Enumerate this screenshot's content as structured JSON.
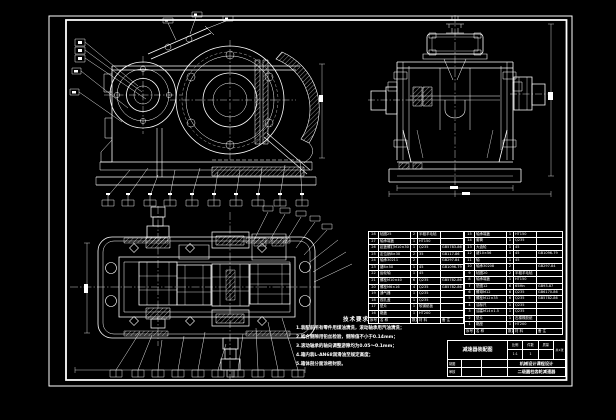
{
  "colors": {
    "background": "#000000",
    "line": "#ffffff"
  },
  "tech_notes": {
    "heading": "技术要求",
    "lines": [
      "1.装配前所有零件用煤油清洗，滚动轴承用汽油清洗；",
      "2.啮合侧隙用铅丝检验，侧隙值不小于0.14mm；",
      "3.滚动轴承的轴向调整游隙均为0.05～0.1mm；",
      "4.箱内装L-AN68润滑油至规定高度；",
      "5.箱体剖分面涂密封胶。"
    ]
  },
  "bom": {
    "left_rows": [
      {
        "no": "28",
        "name": "毡圈25",
        "qty": "2",
        "mat": "半粗羊毛毡",
        "note": ""
      },
      {
        "no": "27",
        "name": "轴承端盖",
        "qty": "1",
        "mat": "HT150",
        "note": ""
      },
      {
        "no": "26",
        "name": "起盖螺钉M10×30",
        "qty": "1",
        "mat": "Q235",
        "note": "GB5783-86"
      },
      {
        "no": "25",
        "name": "定位销8×30",
        "qty": "2",
        "mat": "35",
        "note": "GB117-86"
      },
      {
        "no": "24",
        "name": "轴承30211",
        "qty": "2",
        "mat": "",
        "note": "GB297-84"
      },
      {
        "no": "23",
        "name": "键8×50",
        "qty": "1",
        "mat": "45",
        "note": "GB1096-79"
      },
      {
        "no": "22",
        "name": "齿轮轴",
        "qty": "1",
        "mat": "45",
        "note": ""
      },
      {
        "no": "21",
        "name": "螺栓M10×40",
        "qty": "6",
        "mat": "Q235",
        "note": "GB5782-86"
      },
      {
        "no": "20",
        "name": "螺栓M6×16",
        "qty": "4",
        "mat": "Q235",
        "note": "GB5782-86"
      },
      {
        "no": "19",
        "name": "通气器",
        "qty": "1",
        "mat": "Q235",
        "note": ""
      },
      {
        "no": "18",
        "name": "视孔盖",
        "qty": "1",
        "mat": "Q235",
        "note": ""
      },
      {
        "no": "17",
        "name": "垫片",
        "qty": "1",
        "mat": "软钢纸板",
        "note": ""
      },
      {
        "no": "16",
        "name": "箱盖",
        "qty": "1",
        "mat": "HT200",
        "note": ""
      },
      {
        "no": "序号",
        "name": "名  称",
        "qty": "数量",
        "mat": "材  料",
        "note": "备  注"
      }
    ],
    "right_rows": [
      {
        "no": "15",
        "name": "轴承端盖",
        "qty": "1",
        "mat": "HT150",
        "note": ""
      },
      {
        "no": "14",
        "name": "套筒",
        "qty": "1",
        "mat": "Q235",
        "note": ""
      },
      {
        "no": "13",
        "name": "大齿轮",
        "qty": "1",
        "mat": "45",
        "note": ""
      },
      {
        "no": "12",
        "name": "键10×56",
        "qty": "1",
        "mat": "45",
        "note": "GB1096-79"
      },
      {
        "no": "11",
        "name": "轴",
        "qty": "1",
        "mat": "45",
        "note": ""
      },
      {
        "no": "10",
        "name": "轴承30208",
        "qty": "2",
        "mat": "",
        "note": "GB297-84"
      },
      {
        "no": "9",
        "name": "毡圈20",
        "qty": "2",
        "mat": "半粗羊毛毡",
        "note": ""
      },
      {
        "no": "8",
        "name": "轴承端盖",
        "qty": "1",
        "mat": "HT150",
        "note": ""
      },
      {
        "no": "7",
        "name": "垫圈12",
        "qty": "6",
        "mat": "65Mn",
        "note": "GB93-87"
      },
      {
        "no": "6",
        "name": "螺母M12",
        "qty": "6",
        "mat": "Q235",
        "note": "GB6170-86"
      },
      {
        "no": "5",
        "name": "螺栓M12×35",
        "qty": "6",
        "mat": "Q235",
        "note": "GB5782-86"
      },
      {
        "no": "4",
        "name": "油标尺",
        "qty": "1",
        "mat": "Q235",
        "note": ""
      },
      {
        "no": "3",
        "name": "油塞M14×1.5",
        "qty": "1",
        "mat": "Q235",
        "note": ""
      },
      {
        "no": "2",
        "name": "垫片",
        "qty": "1",
        "mat": "石棉橡胶纸",
        "note": ""
      },
      {
        "no": "1",
        "name": "箱座",
        "qty": "1",
        "mat": "HT200",
        "note": ""
      },
      {
        "no": "序号",
        "name": "名  称",
        "qty": "数量",
        "mat": "材  料",
        "note": "备  注"
      }
    ]
  },
  "title_block": {
    "title": "减速器装配图",
    "scale_label": "比例",
    "scale_value": "1:1",
    "qty_label": "件数",
    "qty_value": "1",
    "weight_label": "质量",
    "weight_value": "",
    "sheet_note": "共1张",
    "drawn_label": "制图",
    "drawn_name": "",
    "drawn_date": "",
    "checked_label": "审核",
    "checked_name": "",
    "checked_date": "",
    "org_line1": "机械设计课程设计",
    "org_line2": "二级圆柱齿轮减速器"
  }
}
